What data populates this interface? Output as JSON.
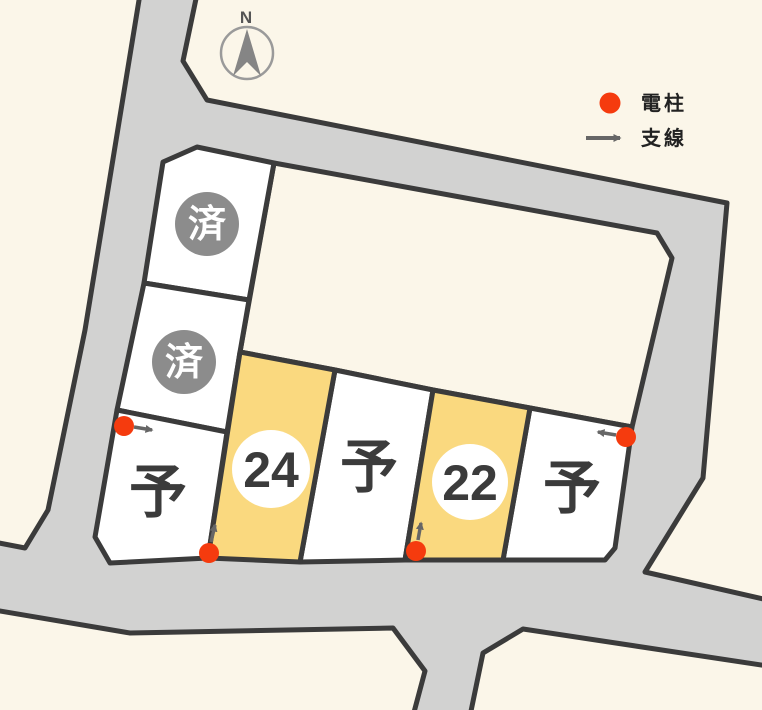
{
  "compass": {
    "label": "N"
  },
  "legend": {
    "items": [
      {
        "icon": "utility-pole-dot",
        "label": "電柱"
      },
      {
        "icon": "guy-wire-arrow",
        "label": "支線"
      }
    ]
  },
  "lots": {
    "items": [
      {
        "id": "sold-upper",
        "label": "済",
        "status": "sold"
      },
      {
        "id": "sold-lower",
        "label": "済",
        "status": "sold"
      },
      {
        "id": "reserved-left",
        "label": "予",
        "status": "reserved"
      },
      {
        "id": "lot-24",
        "label": "24",
        "status": "highlighted"
      },
      {
        "id": "reserved-middle",
        "label": "予",
        "status": "reserved"
      },
      {
        "id": "lot-22",
        "label": "22",
        "status": "highlighted"
      },
      {
        "id": "reserved-right",
        "label": "予",
        "status": "reserved"
      }
    ]
  },
  "colors": {
    "background": "#FBF6E9",
    "road": "#D2D2D1",
    "lot_white": "#FFFFFF",
    "lot_highlight": "#FAD97F",
    "sold_badge": "#8C8C8C",
    "outline": "#3B3B3B",
    "utility_pole": "#F53B0E",
    "arrow": "#666666"
  }
}
